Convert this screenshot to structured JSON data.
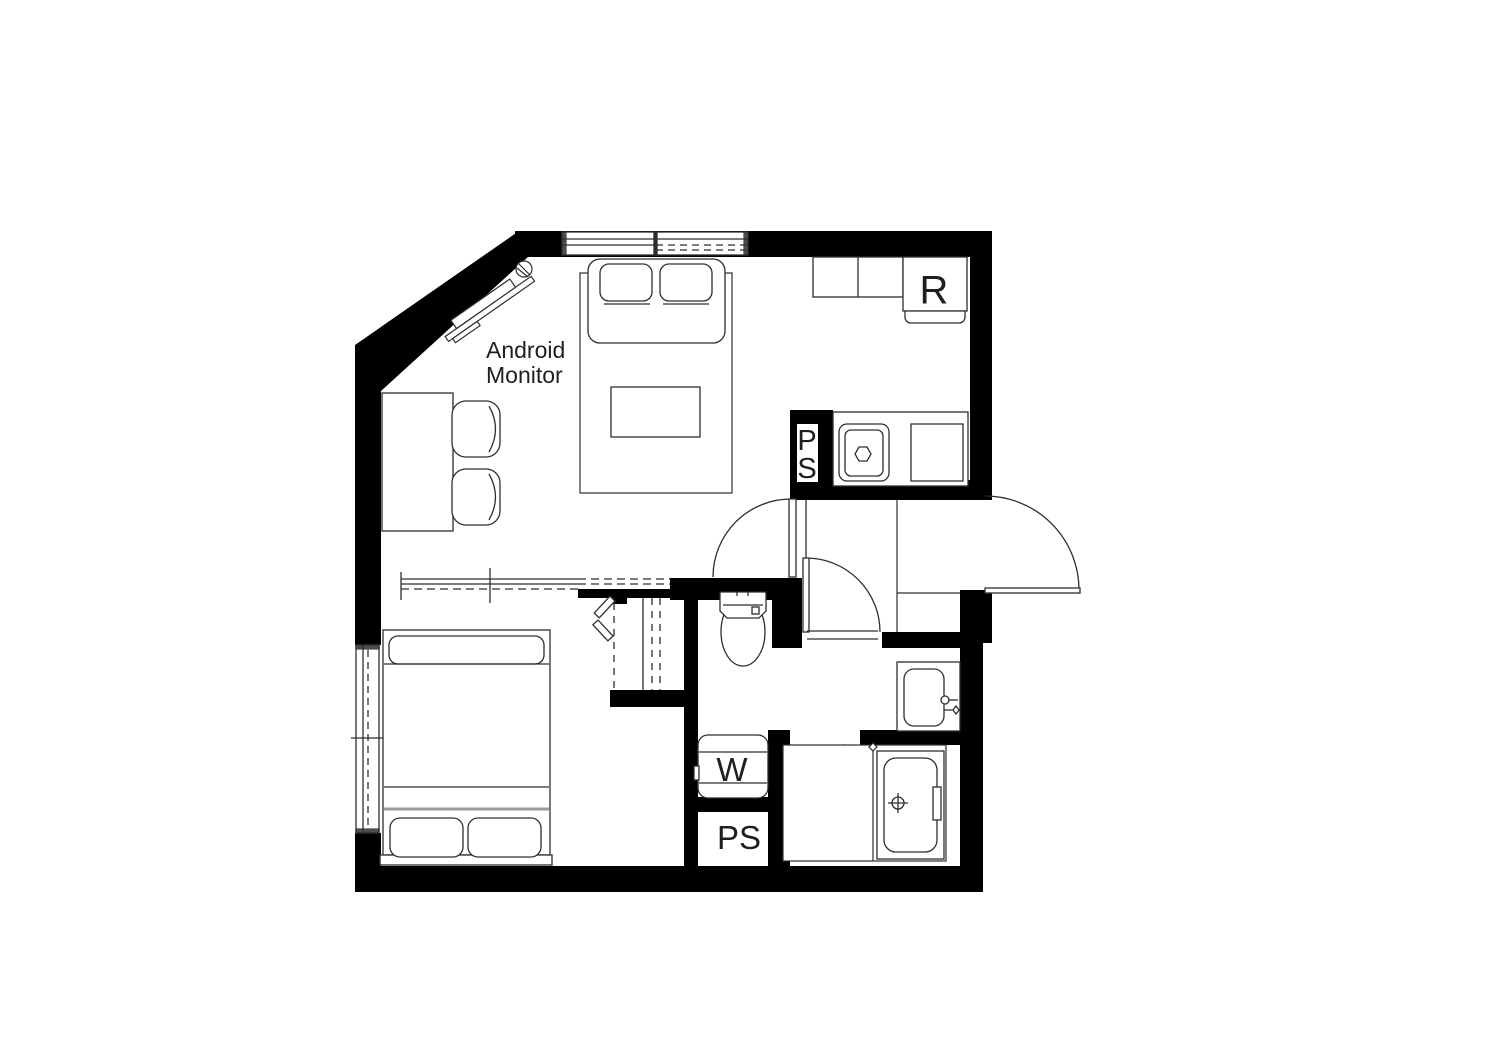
{
  "plan": {
    "labels": {
      "monitor_line1": "Android",
      "monitor_line2": "Monitor",
      "refrigerator": "R",
      "pipe_space_kitchen_line1": "P",
      "pipe_space_kitchen_line2": "S",
      "washing_machine": "W",
      "pipe_space_bottom": "PS"
    },
    "colors": {
      "wall": "#000000",
      "line": "#2e2e2e",
      "background": "#ffffff"
    }
  }
}
